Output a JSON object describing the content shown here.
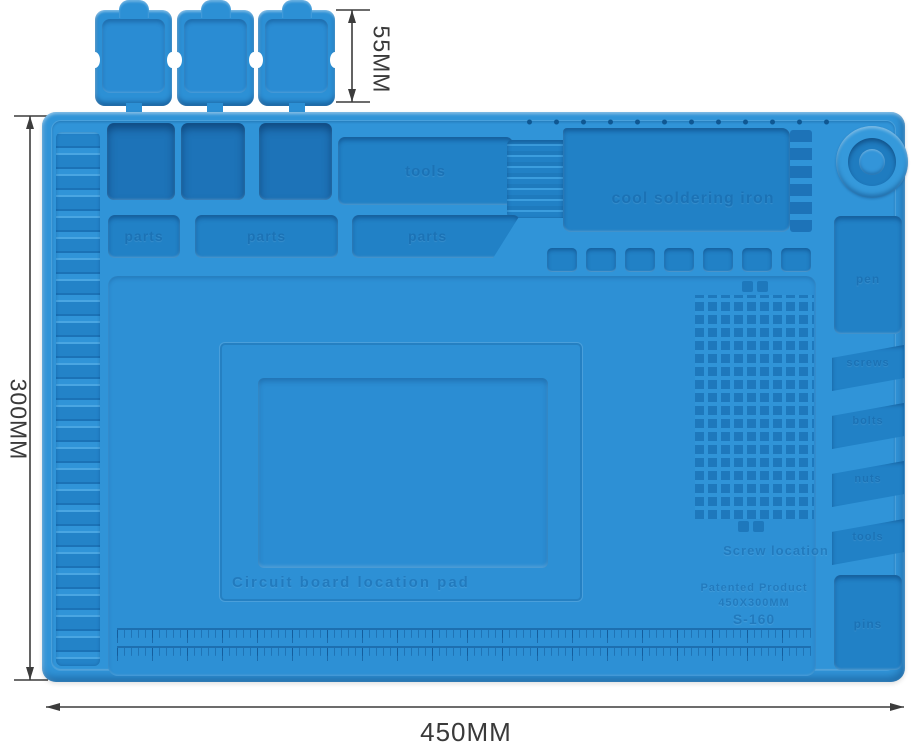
{
  "dimensions": {
    "top": "55MM",
    "left": "300MM",
    "bottom": "450MM"
  },
  "mat_labels": {
    "row1_tray": "tools",
    "soldering_tray": "cool soldering iron",
    "row2_trays": [
      "parts",
      "parts",
      "parts"
    ],
    "right_column": {
      "pen_tray": "pen",
      "slant_trays": [
        "screws",
        "bolts",
        "nuts",
        "tools"
      ],
      "bottom_tray": "pins"
    },
    "center_pad": "Circuit board location pad",
    "screw_grid_title": "Screw location",
    "patent_lines": [
      "Patented Product",
      "450X300MM",
      "S-160"
    ]
  },
  "colors": {
    "mat_blue": "#3094d8",
    "recess_blue": "#2181c6",
    "deep_blue": "#1d73b8",
    "lid_blue": "#2c90d5",
    "dimension_text": "#3a3a3a",
    "background": "#ffffff"
  }
}
